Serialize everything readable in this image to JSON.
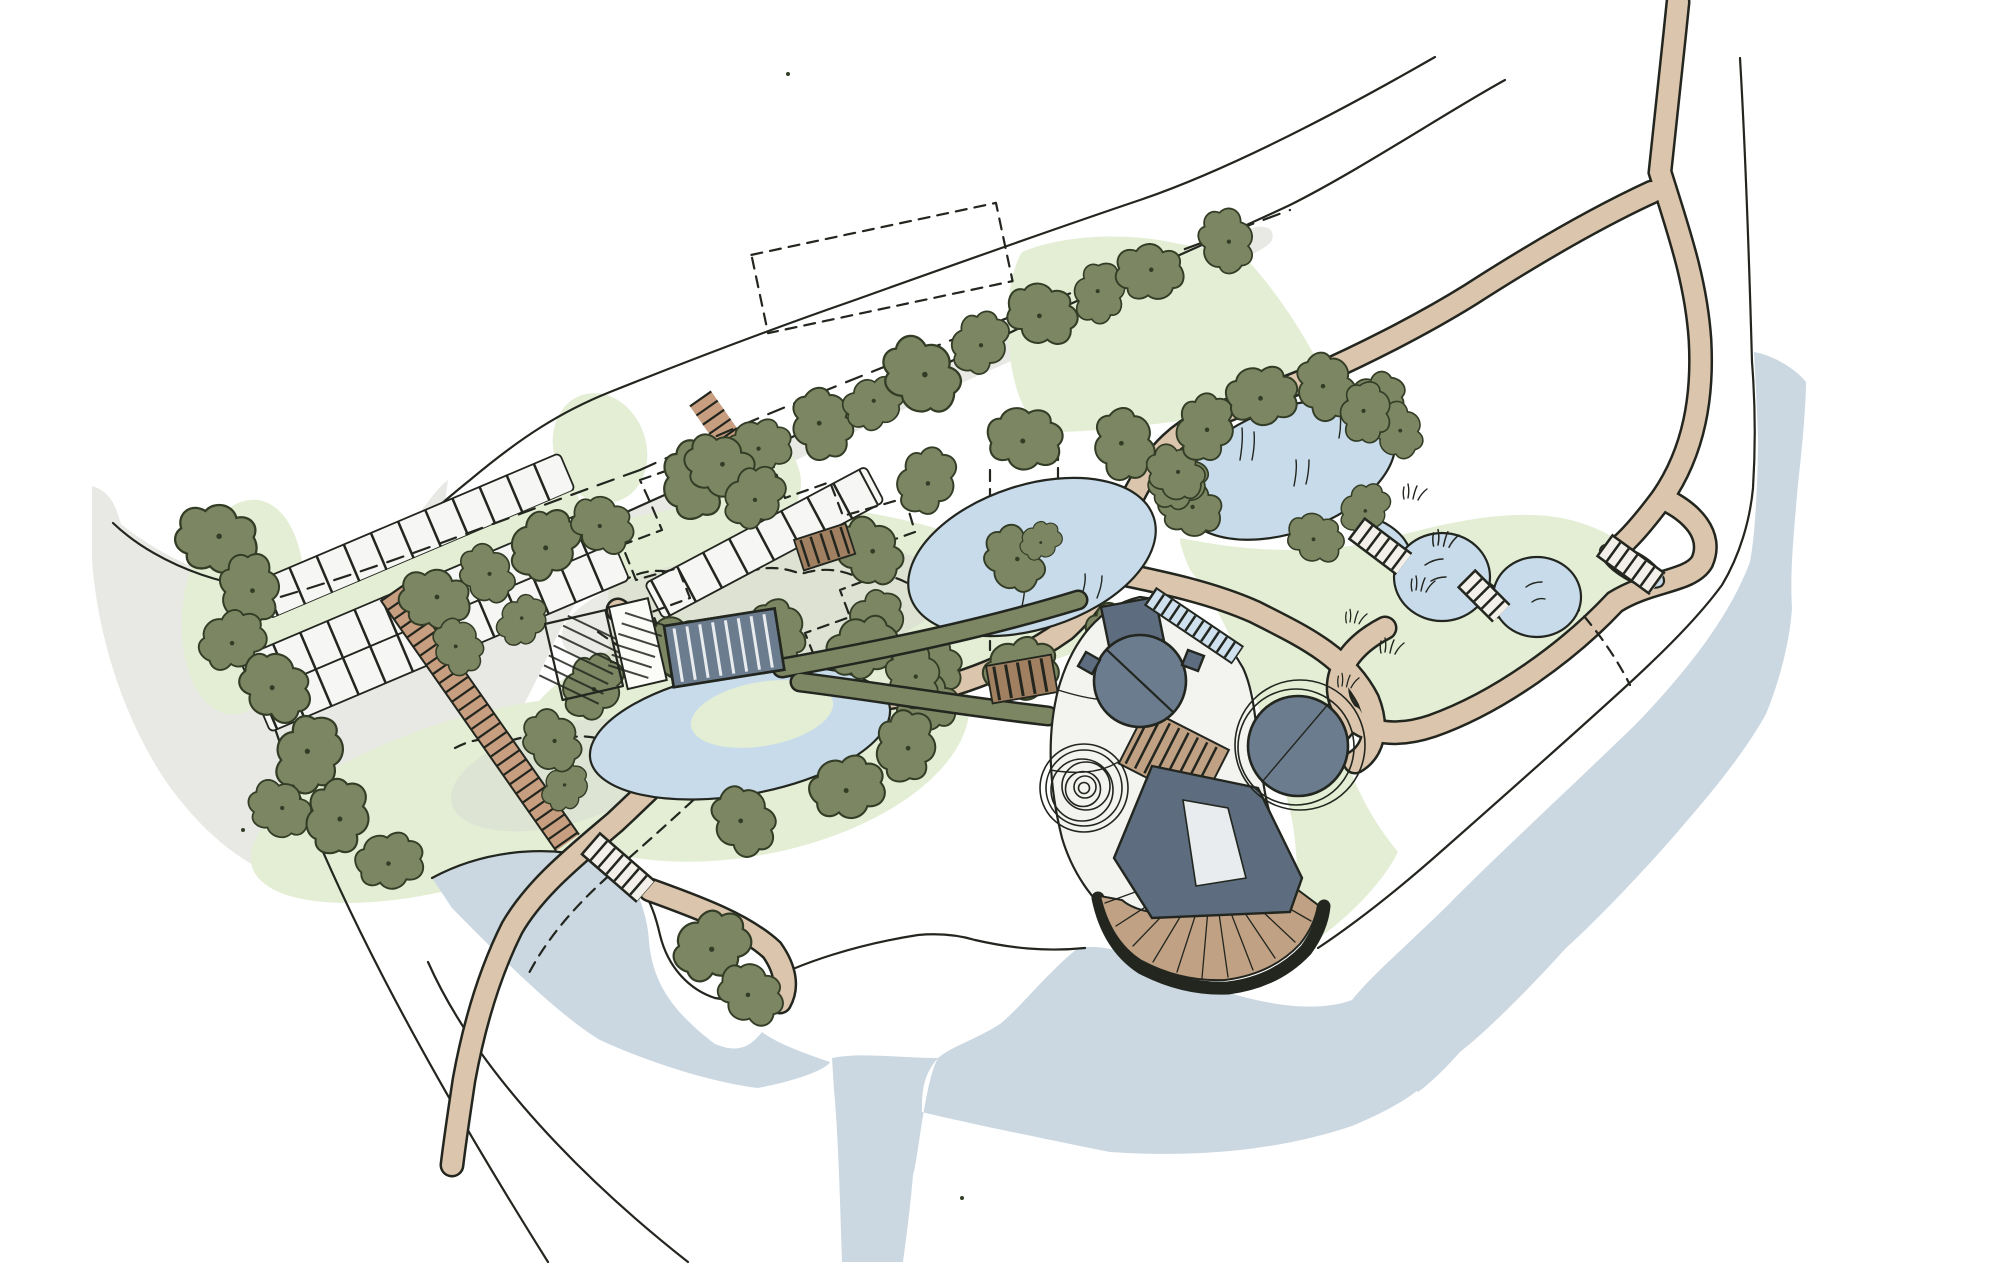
{
  "meta": {
    "title": "Hand-drawn landscape masterplan site sketch",
    "canvas_width": "2000",
    "canvas_height": "1264"
  },
  "palette": {
    "paper": "#ffffff",
    "ink": "#22261f",
    "road": "#e8e8e5",
    "wash": "#d9d9d2",
    "grass": "#e3eed5",
    "lake": "#cbd8e2",
    "pond": "#c8dbeb",
    "path": "#dcc5ad",
    "hatch": "#c79e7f",
    "deck": "#c0a184",
    "deck_rim": "#a8876a",
    "timber": "#a08060",
    "building": "#6c7c8f",
    "building_dark": "#5d6d7f",
    "roof_light": "#e9ecef",
    "bay": "#f6f6f4",
    "plaza": "#f3f3f0",
    "tree": "#7d8663",
    "tree_ink": "#333d26",
    "bridge": "#f3efe9",
    "rill": "#cfe0ee"
  },
  "features": {
    "plan": "landscape-masterplan-sketch",
    "road": "existing-road-surface",
    "lane": "site-boundary-lane",
    "parking": "parking-court",
    "spine": "hatched-pedestrian-spine",
    "lake": "lake",
    "pond_upper": "upper-pond-with-island",
    "pond_reed": "reed-pond",
    "wetland": "wetland-pond-chain",
    "pond_lower": "lower-pond-garden",
    "paths": "footpath-network",
    "trees": "tree-belts-and-rings",
    "greens": "meadow-greens",
    "buildings": "visitor-centre-complex",
    "deck": "timber-event-deck",
    "spiral": "spiral-labyrinth",
    "bridges": "boardwalk-bridges",
    "rill": "stepped-water-rill",
    "plots": "proposed-plot-outlines-dashed",
    "barn": "hatched-barn",
    "canopy": "striped-canopy-building"
  }
}
